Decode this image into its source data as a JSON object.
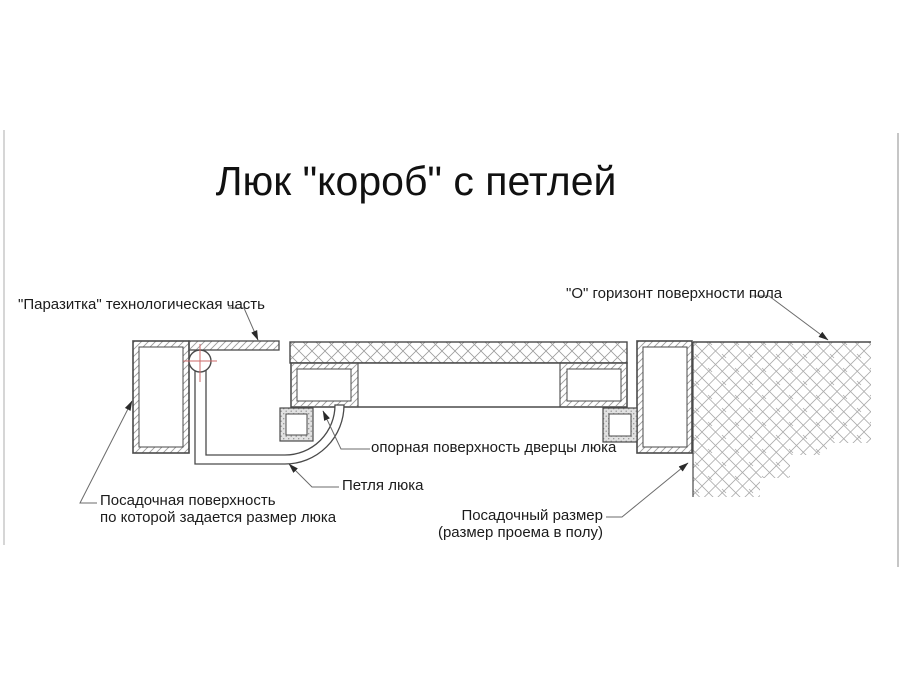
{
  "title": "Люк \"короб\" с петлей",
  "labels": {
    "parasitka": "\"Паразитка\" технологическая часть",
    "horizon": "\"О\" горизонт поверхности пола",
    "support_surface": "опорная поверхность дверцы люка",
    "hinge": "Петля люка",
    "seating_surface": {
      "line1": "Посадочная поверхность",
      "line2": "по которой задается размер люка"
    },
    "seating_size": {
      "line1": "Посадочный размер",
      "line2": "(размер проема в полу)"
    }
  },
  "colors": {
    "background": "#ffffff",
    "drawing_line": "#4a4a4a",
    "hatch_line": "#9c9c9c",
    "leader_line": "#6b6b6b",
    "axis_crosshair_red": "#cc6a6a",
    "hinge_block_fill": "#e2e2e2",
    "text": "#1b1b1b"
  }
}
